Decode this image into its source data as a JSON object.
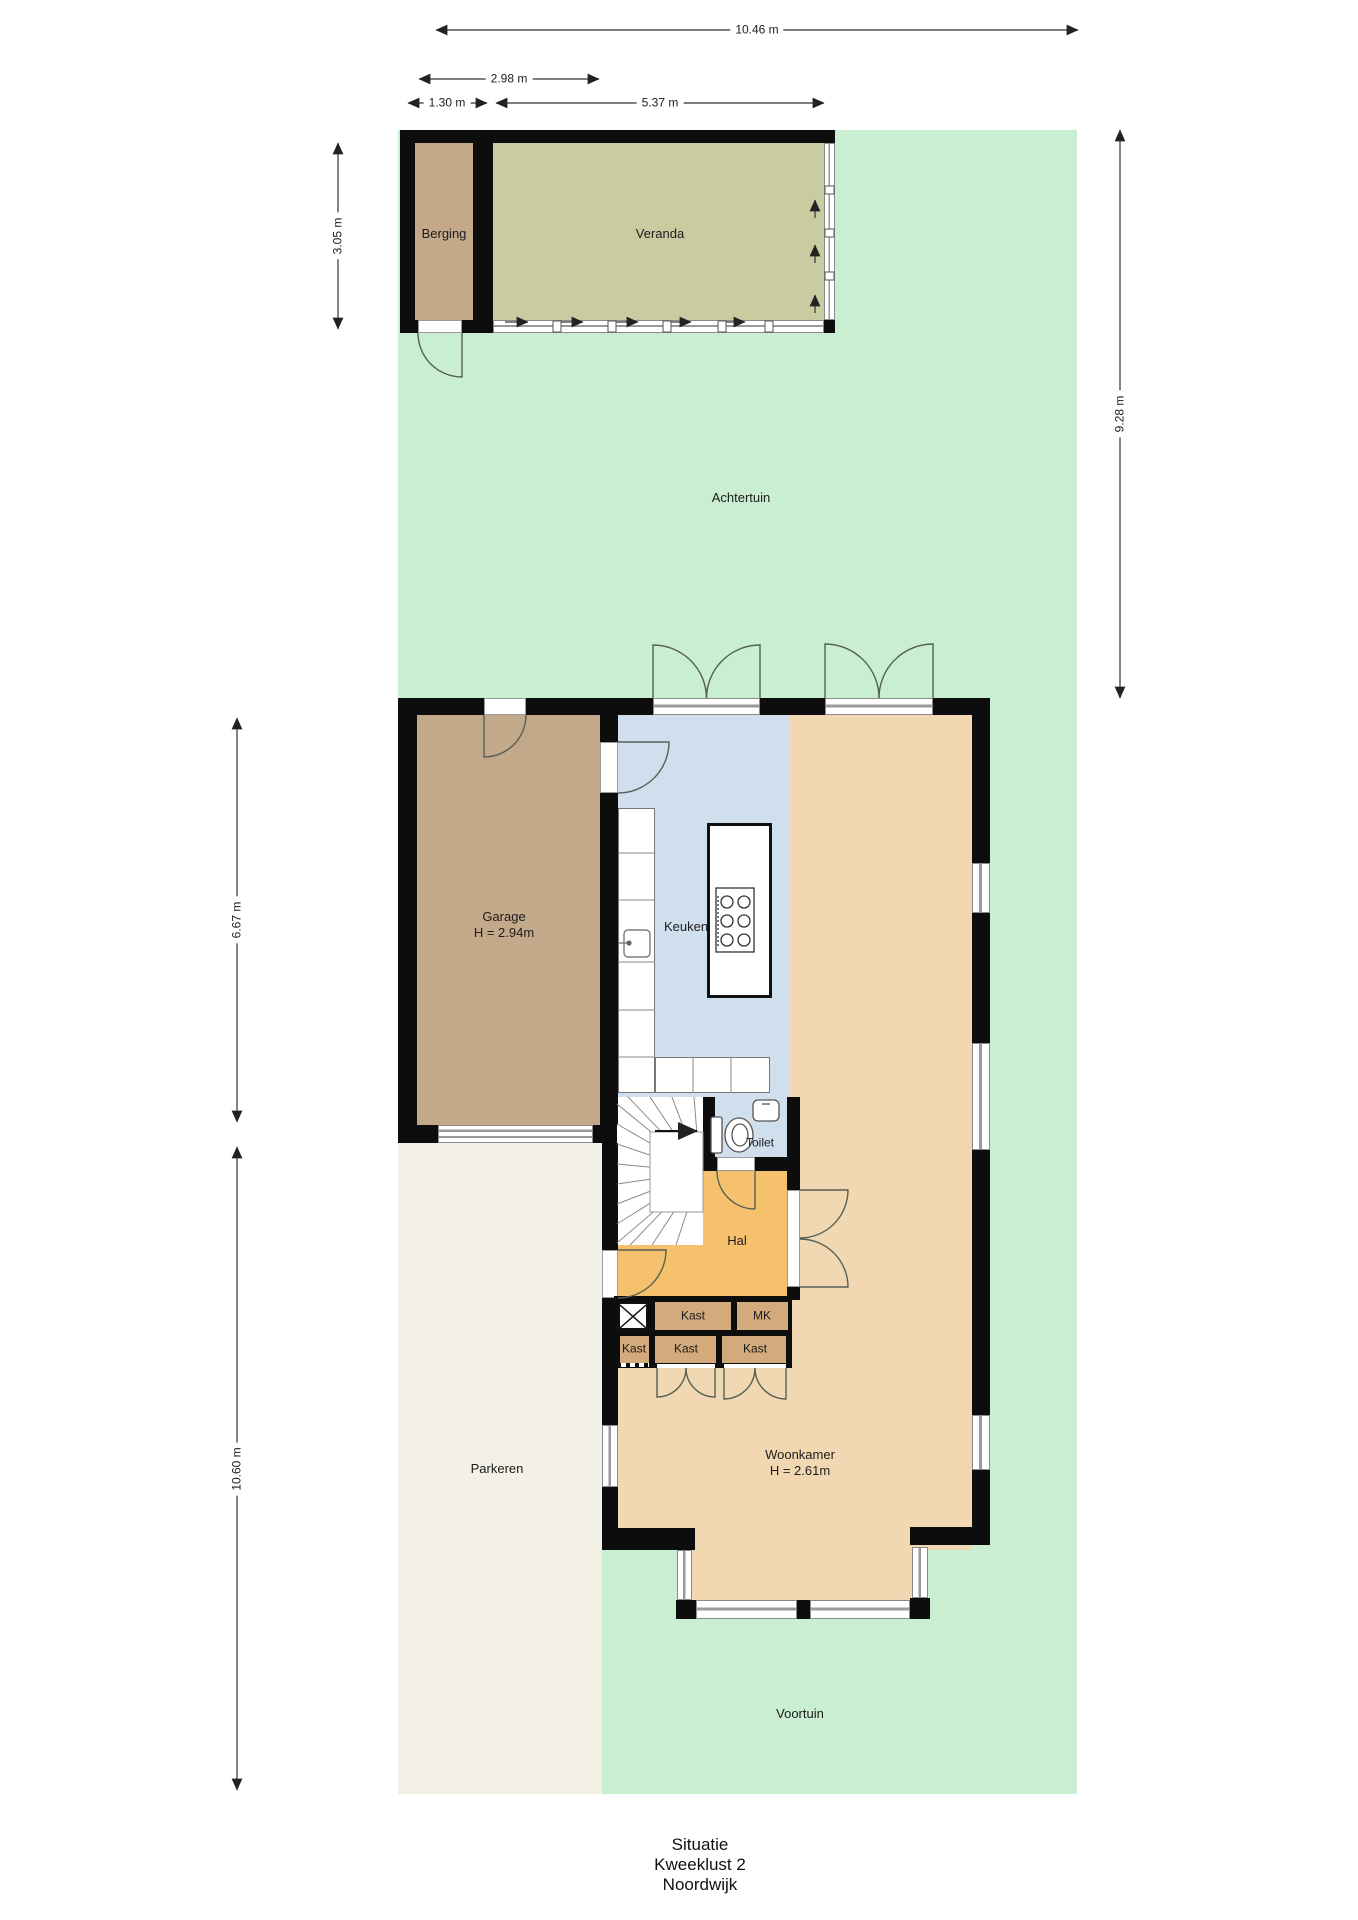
{
  "title": {
    "line1": "Situatie",
    "line2": "Kweeklust 2",
    "line3": "Noordwijk"
  },
  "areas": {
    "achtertuin": "Achtertuin",
    "voortuin": "Voortuin",
    "parkeren": "Parkeren"
  },
  "rooms": {
    "berging": "Berging",
    "veranda": "Veranda",
    "garage_name": "Garage",
    "garage_height": "H = 2.94m",
    "keuken": "Keuken",
    "toilet": "Toilet",
    "hal": "Hal",
    "woonkamer_name": "Woonkamer",
    "woonkamer_height": "H = 2.61m",
    "kast_upper": "Kast",
    "mk": "MK",
    "kast_a": "Kast",
    "kast_b": "Kast",
    "kast_c": "Kast"
  },
  "dimensions": {
    "total_width": "10.46 m",
    "berging_veranda": "2.98 m",
    "berging_width": "1.30 m",
    "veranda_width": "5.37 m",
    "berging_depth": "3.05 m",
    "achtertuin_depth": "9.28 m",
    "garage_depth": "6.67 m",
    "parkeren_depth": "10.60 m"
  },
  "colors": {
    "garden_green": "#c9eed2",
    "storage_tan": "#c4a88a",
    "veranda_olive": "#c9cba0",
    "kitchen_blue": "#cfdfee",
    "living_beige": "#f1d8b2",
    "hall_orange": "#f6c16d",
    "closet_tan": "#d2aa7c",
    "paving_cream": "#f3f1e6",
    "wall_black": "#0d0d0d"
  }
}
